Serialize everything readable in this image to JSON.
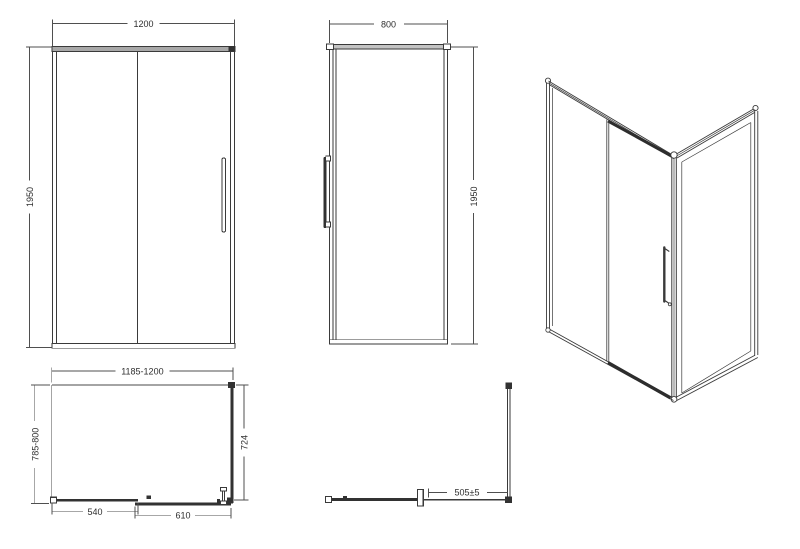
{
  "views": {
    "front": {
      "width": "1200",
      "height": "1950"
    },
    "side": {
      "width": "800",
      "height": "1950"
    },
    "plan": {
      "width": "1185-1200",
      "depth": "785-800",
      "side_panel": "724",
      "fixed_panel": "540",
      "sliding_door": "610"
    },
    "side_plan": {
      "offset": "505±5"
    }
  },
  "colors": {
    "line": "#3a3a3a",
    "dimension_line": "#4f4f4f",
    "rail_fill": "#a8a8a8",
    "background": "#ffffff"
  }
}
